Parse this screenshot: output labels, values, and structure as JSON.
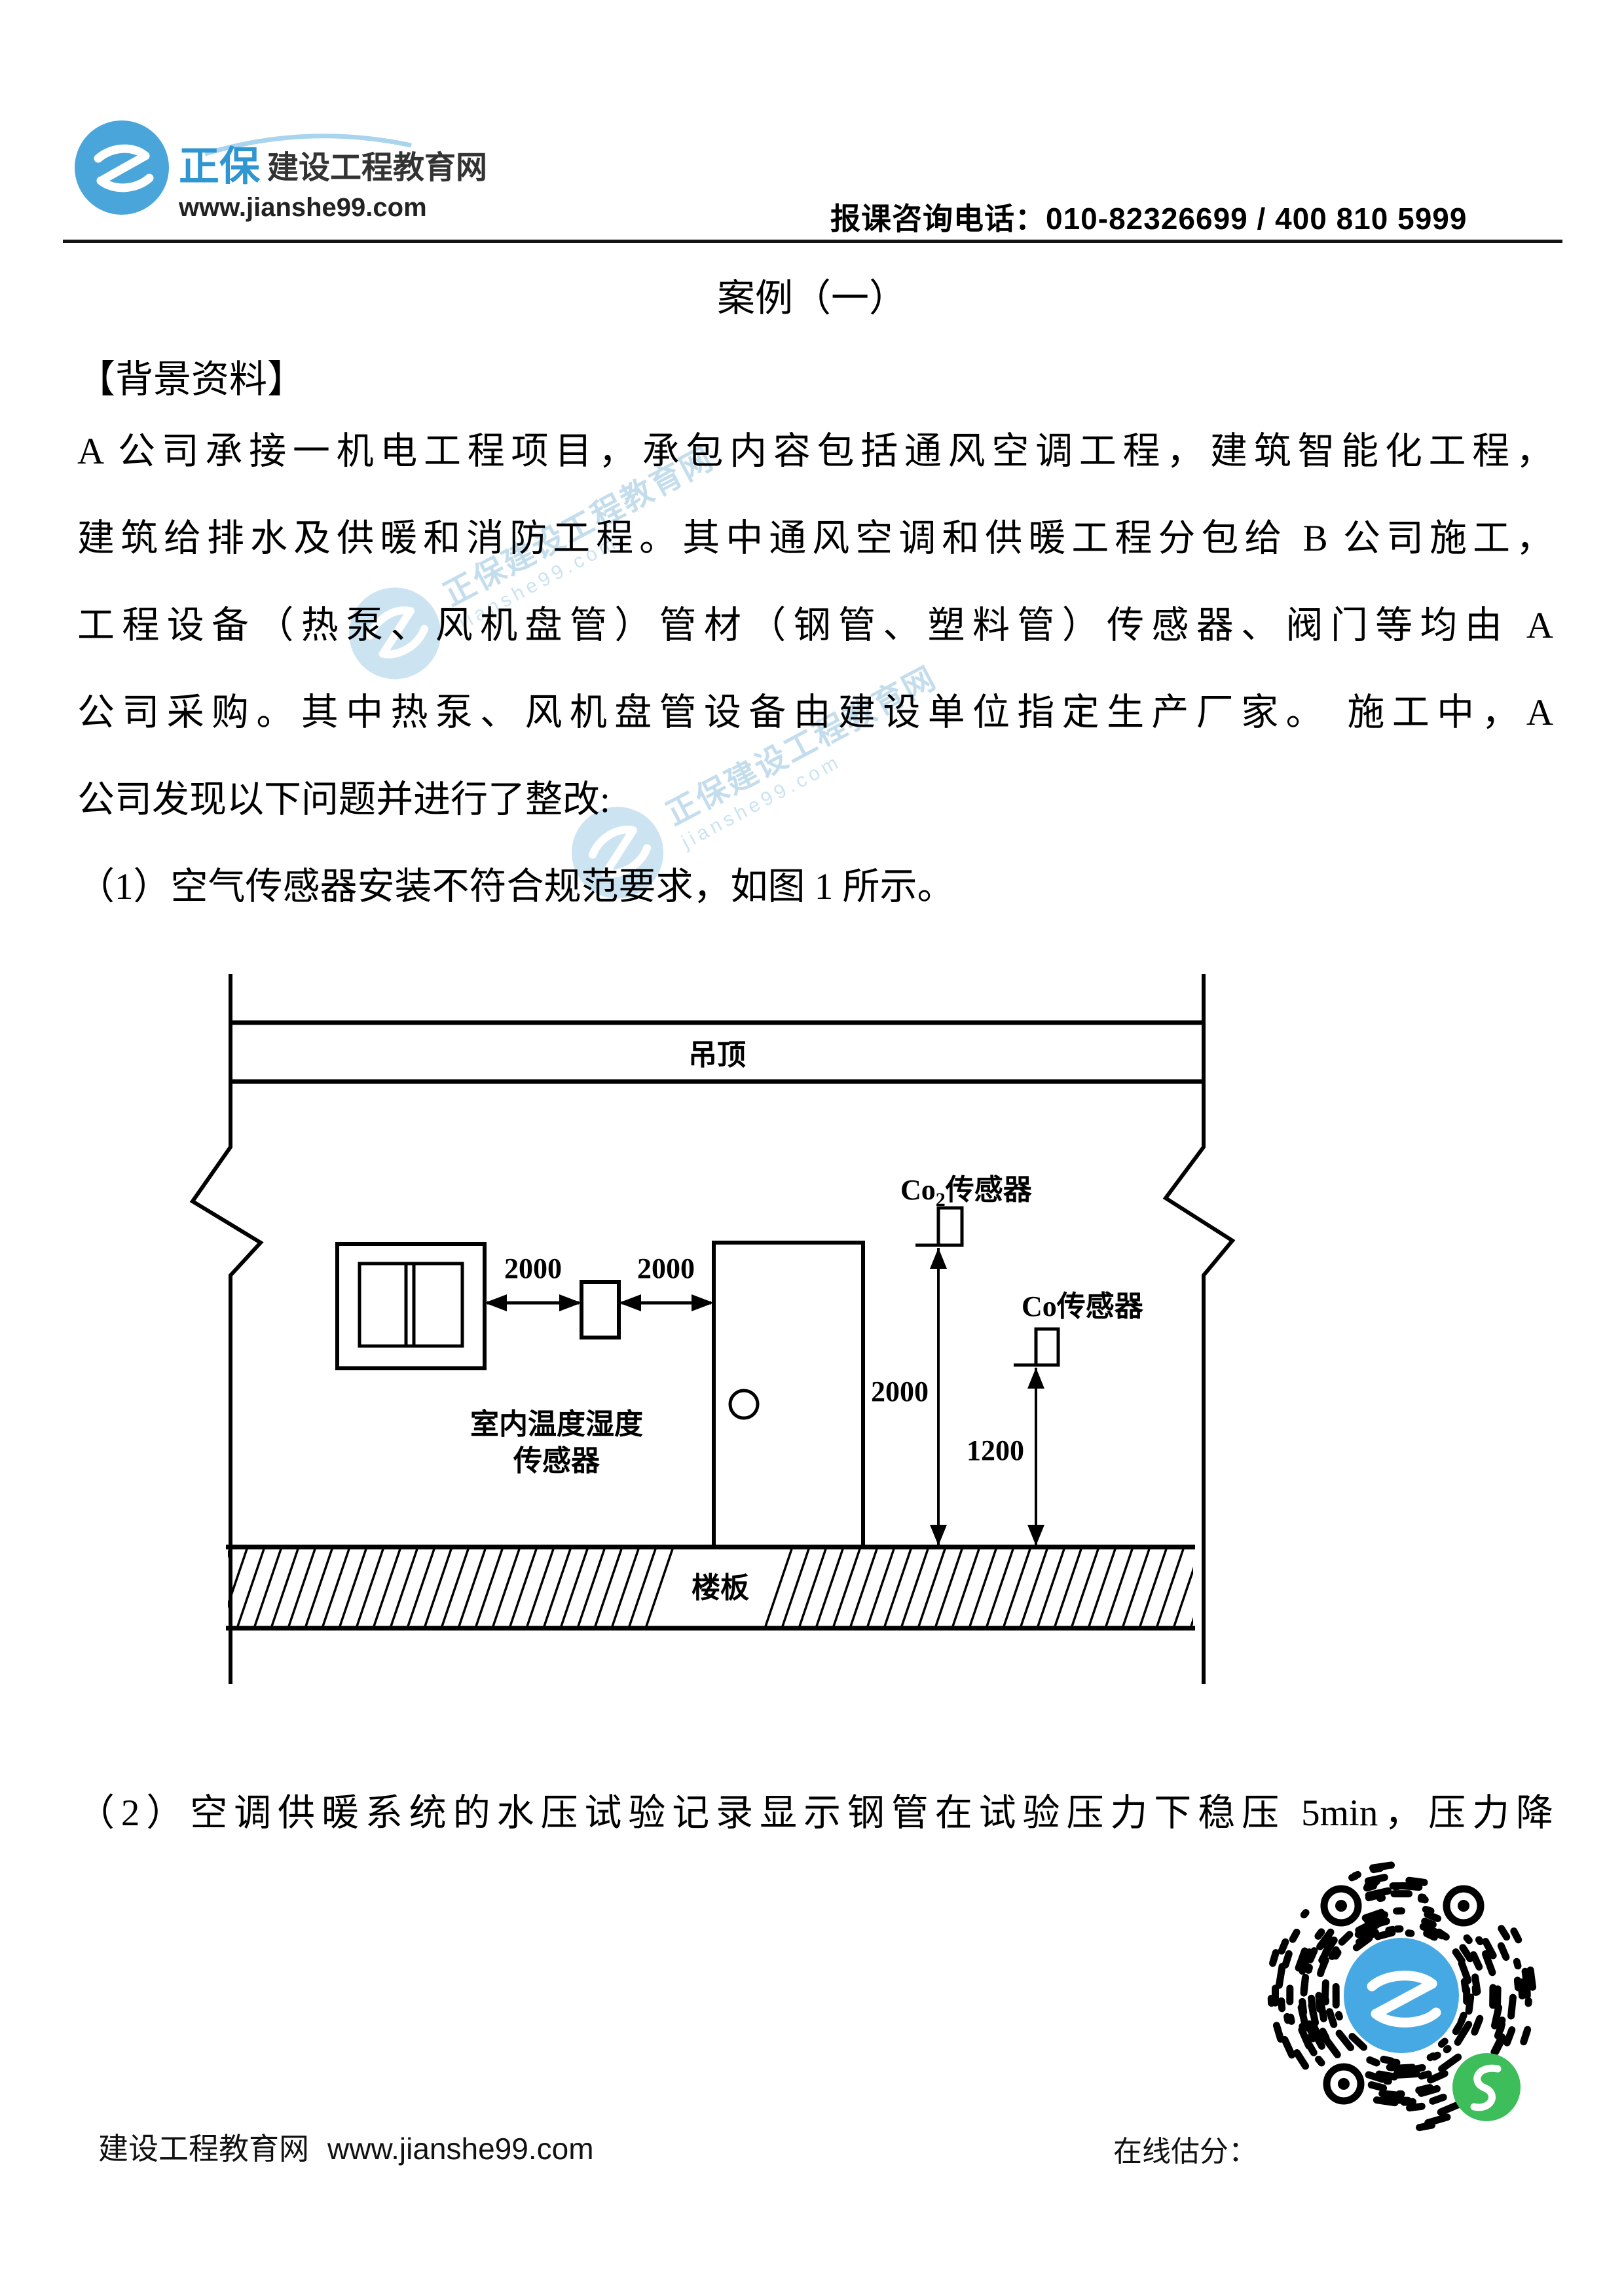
{
  "header": {
    "brand_cn": "正保",
    "brand_suffix": "建设工程教育网",
    "brand_url": "www.jianshe99.com",
    "phone_line": "报课咨询电话：010-82326699 / 400 810 5999"
  },
  "title": "案例（一）",
  "section_heading": "【背景资料】",
  "paragraph_lines": [
    "A 公司承接一机电工程项目，承包内容包括通风空调工程，建筑智能化工程，",
    "建筑给排水及供暖和消防工程。其中通风空调和供暖工程分包给 B 公司施工，",
    "工程设备（热泵、风机盘管）管材（钢管、塑料管）传感器、阀门等均由 A",
    "公司采购。其中热泵、风机盘管设备由建设单位指定生产厂家。 施工中，A",
    "公司发现以下问题并进行了整改:",
    "（1）空气传感器安装不符合规范要求，如图 1 所示。"
  ],
  "item2_line": "（2）空调供暖系统的水压试验记录显示钢管在试验压力下稳压 5min，压力降",
  "figure": {
    "ceiling_label": "吊顶",
    "floor_label": "楼板",
    "sensor_label_line1": "室内温度湿度",
    "sensor_label_line2": "传感器",
    "co2_label_prefix": "Co",
    "co2_label_sub": "2",
    "co2_label_suffix": "传感器",
    "co_label": "Co传感器",
    "dim_left": "2000",
    "dim_right": "2000",
    "dim_co2": "2000",
    "dim_co": "1200"
  },
  "watermark": {
    "text": "正保建设工程教育网",
    "subtext": "jianshe99.com"
  },
  "footer": {
    "site_name": "建设工程教育网",
    "site_url": "www.jianshe99.com",
    "score_label": "在线估分："
  },
  "colors": {
    "brand_blue": "#3f9fd8",
    "logo_circle_blue": "#4aa6da",
    "qr_center_blue": "#47a9e4",
    "qr_green": "#3dbe5b",
    "watermark_blue": "#5aa7d6",
    "text_black": "#000000"
  }
}
